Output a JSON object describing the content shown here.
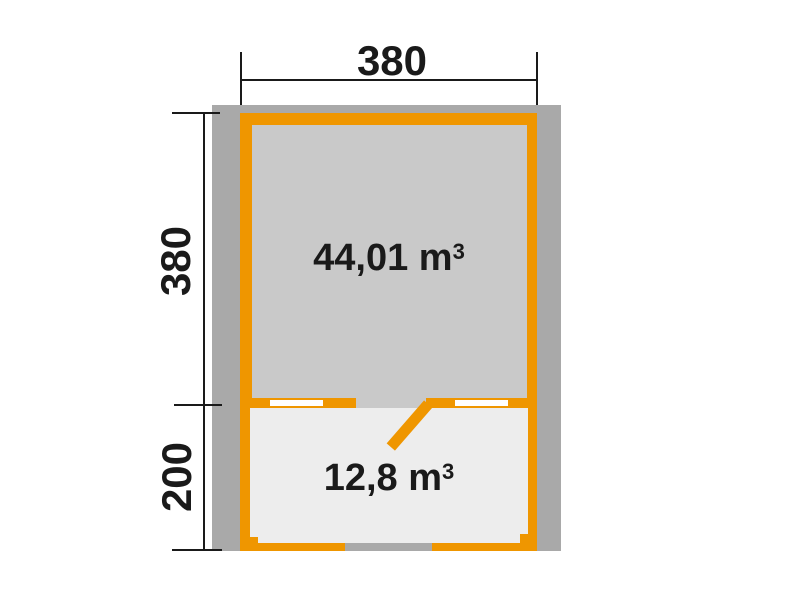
{
  "diagram": {
    "type": "floorplan",
    "dimensions": {
      "top_width": "380",
      "side_upper_depth": "380",
      "side_lower_depth": "200"
    },
    "rooms": {
      "main": {
        "volume": "44,01 m",
        "volume_sup": "3"
      },
      "annex": {
        "volume": "12,8 m",
        "volume_sup": "3"
      }
    },
    "colors": {
      "wall_orange": "#ef9600",
      "overhang_gray": "#a9a9a9",
      "main_room_fill": "#c9c9c9",
      "annex_fill": "#ededed",
      "window_white": "#ffffff",
      "dimension_ink": "#1a1a1a",
      "background": "#ffffff"
    }
  }
}
